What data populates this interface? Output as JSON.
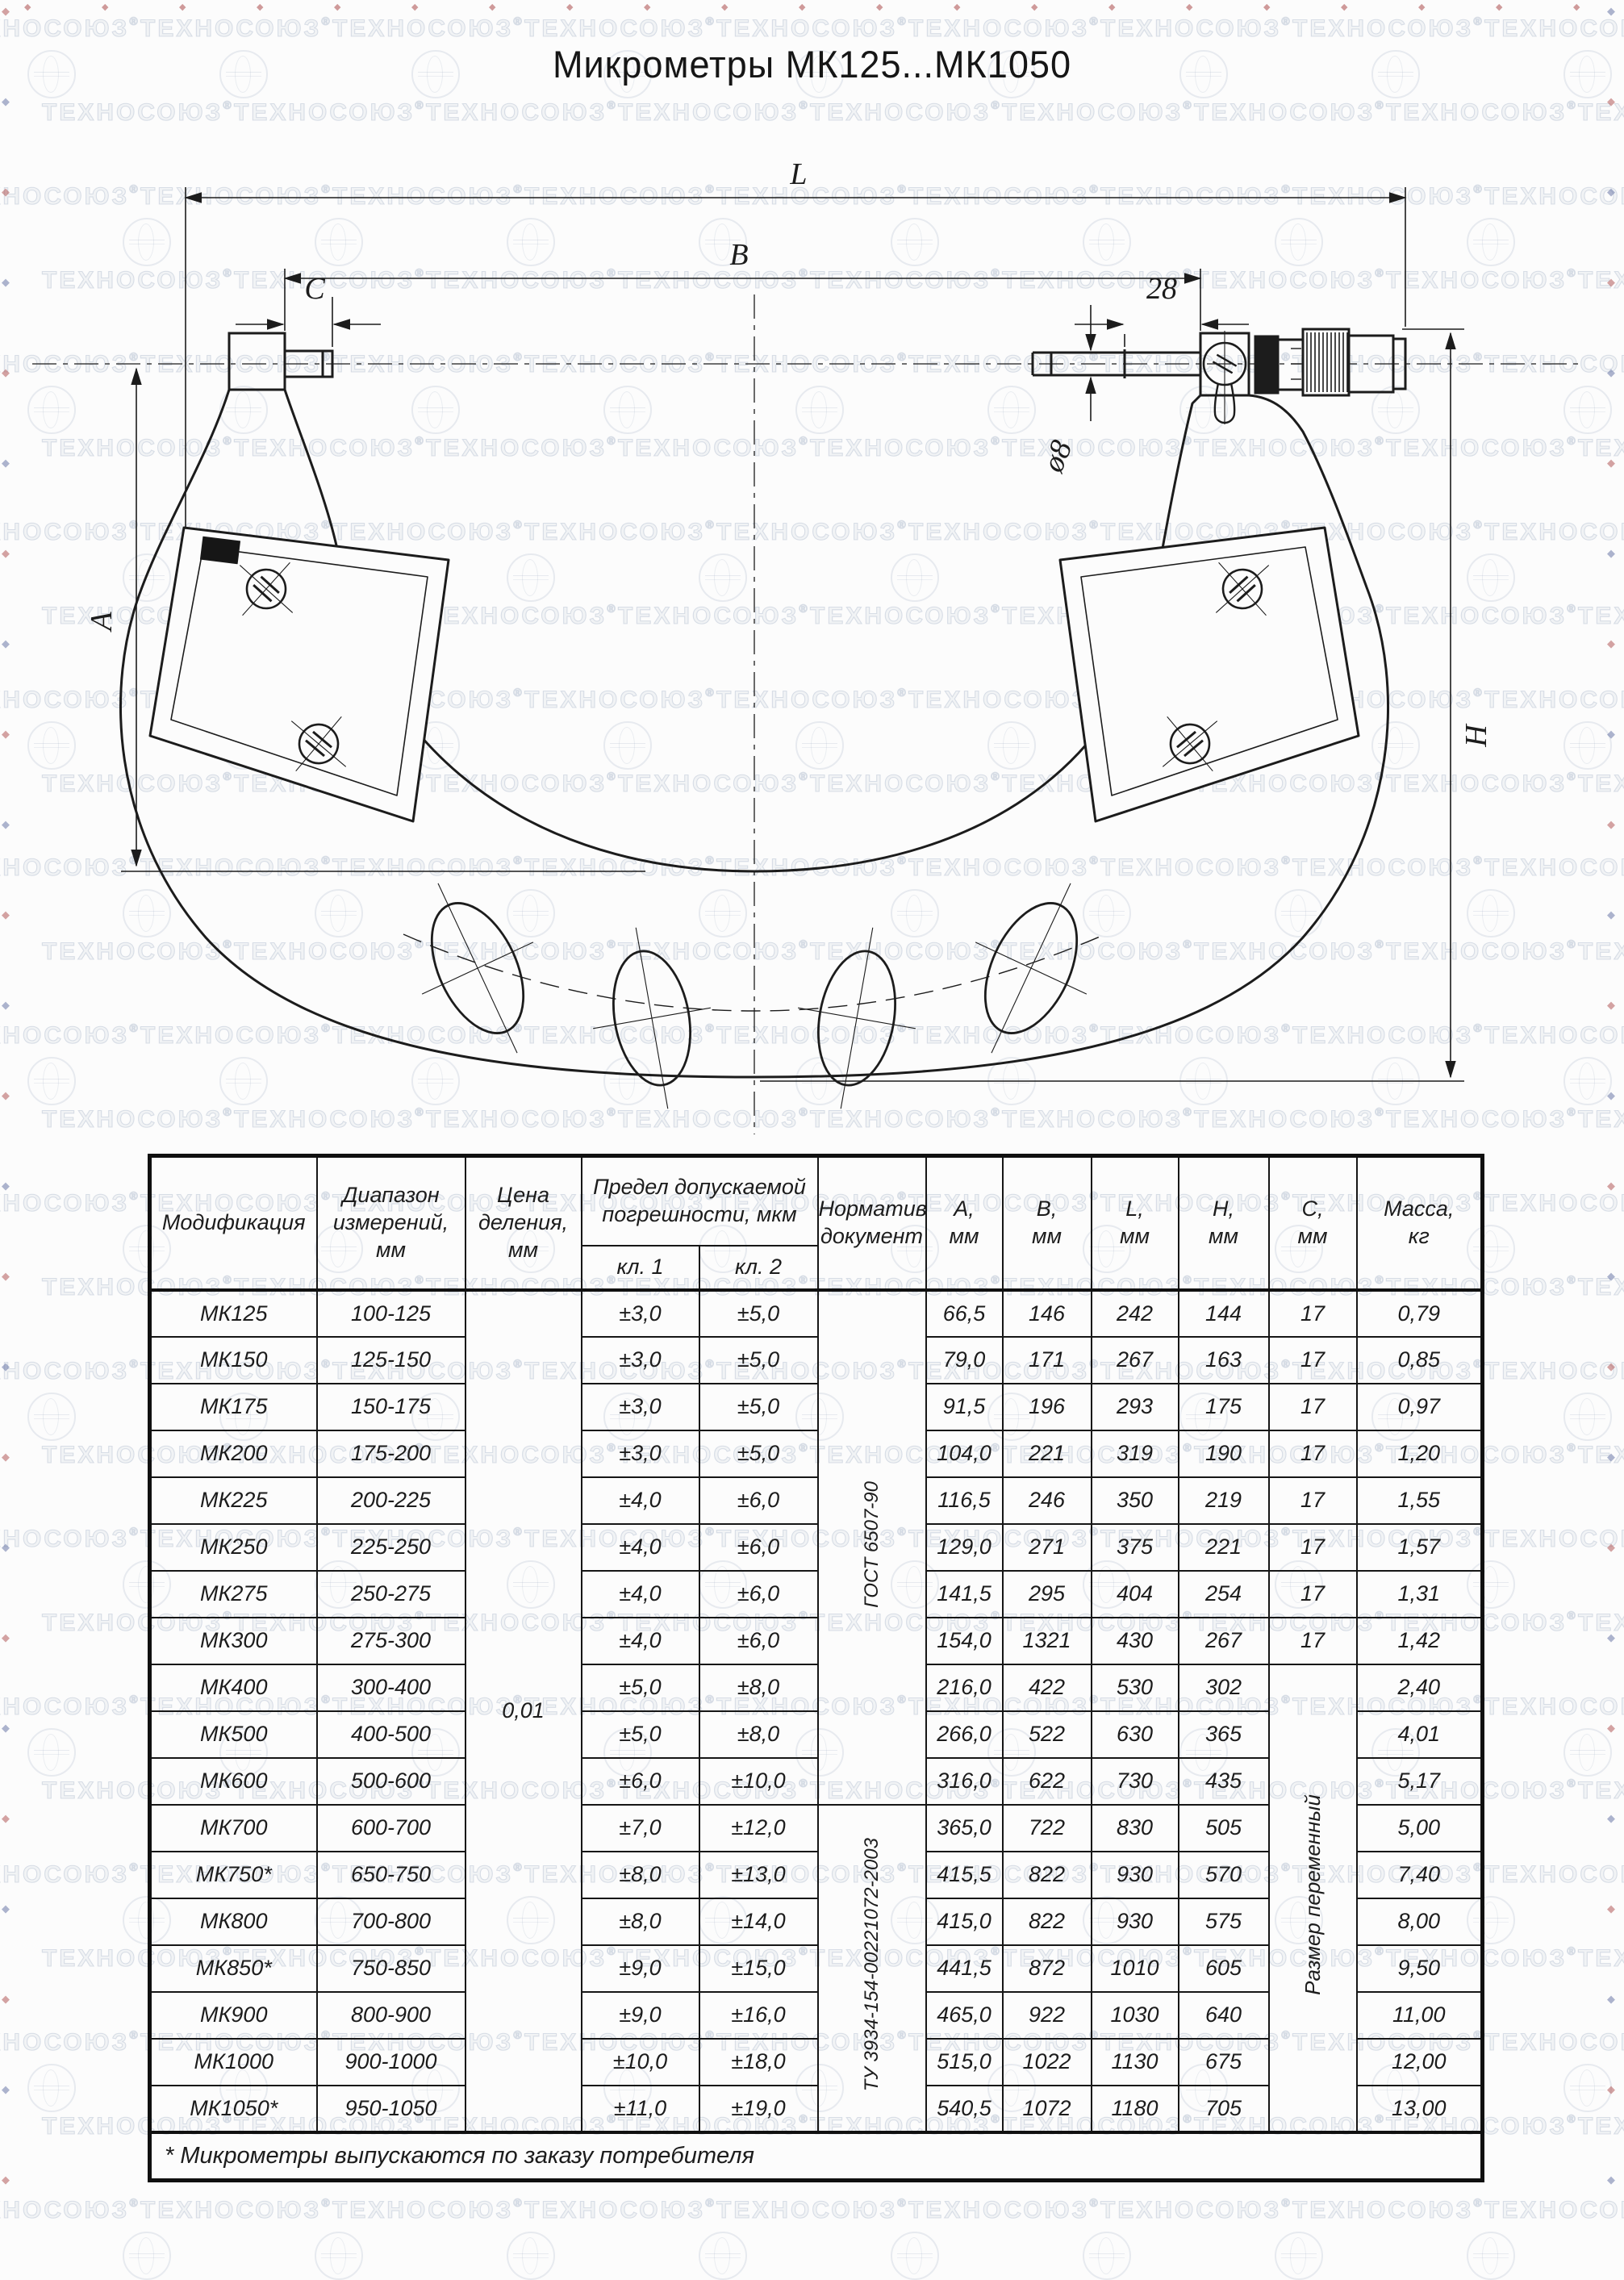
{
  "watermark": {
    "text": "ТЕХНОСОЮЗ",
    "reg": "®",
    "diamond": "◆",
    "edge_color_red": "#b25a5a",
    "edge_color_blue": "#6b79a8"
  },
  "title": "Микрометры МК125...МК1050",
  "drawing": {
    "dim_L": "L",
    "dim_B": "B",
    "dim_C": "C",
    "dim_28": "28",
    "dim_d8": "ø8",
    "dim_A": "A",
    "dim_H": "H"
  },
  "table": {
    "headers": {
      "model": "Модификация",
      "range": "Диапазон\nизмерений,\nмм",
      "division": "Цена\nделения,\nмм",
      "error": "Предел допускаемой\nпогрешности, мкм",
      "kl1": "кл. 1",
      "kl2": "кл. 2",
      "doc": "Нормативный\nдокумент",
      "col_a": "А,\nмм",
      "col_b": "В,\nмм",
      "col_l": "L,\nмм",
      "col_h": "Н,\nмм",
      "col_c": "С,\nмм",
      "mass": "Масса,\nкг"
    },
    "merged": {
      "division_value": "0,01",
      "doc_gost": "ГОСТ 6507-90",
      "doc_tu": "ТУ 3934-154-00221072-2003",
      "c_variable": "Размер переменный"
    },
    "rows": [
      {
        "model": "МК125",
        "range": "100-125",
        "kl1": "±3,0",
        "kl2": "±5,0",
        "a": "66,5",
        "b": "146",
        "l": "242",
        "h": "144",
        "c": "17",
        "mass": "0,79"
      },
      {
        "model": "МК150",
        "range": "125-150",
        "kl1": "±3,0",
        "kl2": "±5,0",
        "a": "79,0",
        "b": "171",
        "l": "267",
        "h": "163",
        "c": "17",
        "mass": "0,85"
      },
      {
        "model": "МК175",
        "range": "150-175",
        "kl1": "±3,0",
        "kl2": "±5,0",
        "a": "91,5",
        "b": "196",
        "l": "293",
        "h": "175",
        "c": "17",
        "mass": "0,97"
      },
      {
        "model": "МК200",
        "range": "175-200",
        "kl1": "±3,0",
        "kl2": "±5,0",
        "a": "104,0",
        "b": "221",
        "l": "319",
        "h": "190",
        "c": "17",
        "mass": "1,20"
      },
      {
        "model": "МК225",
        "range": "200-225",
        "kl1": "±4,0",
        "kl2": "±6,0",
        "a": "116,5",
        "b": "246",
        "l": "350",
        "h": "219",
        "c": "17",
        "mass": "1,55"
      },
      {
        "model": "МК250",
        "range": "225-250",
        "kl1": "±4,0",
        "kl2": "±6,0",
        "a": "129,0",
        "b": "271",
        "l": "375",
        "h": "221",
        "c": "17",
        "mass": "1,57"
      },
      {
        "model": "МК275",
        "range": "250-275",
        "kl1": "±4,0",
        "kl2": "±6,0",
        "a": "141,5",
        "b": "295",
        "l": "404",
        "h": "254",
        "c": "17",
        "mass": "1,31"
      },
      {
        "model": "МК300",
        "range": "275-300",
        "kl1": "±4,0",
        "kl2": "±6,0",
        "a": "154,0",
        "b": "1321",
        "l": "430",
        "h": "267",
        "c": "17",
        "mass": "1,42"
      },
      {
        "model": "МК400",
        "range": "300-400",
        "kl1": "±5,0",
        "kl2": "±8,0",
        "a": "216,0",
        "b": "422",
        "l": "530",
        "h": "302",
        "mass": "2,40"
      },
      {
        "model": "МК500",
        "range": "400-500",
        "kl1": "±5,0",
        "kl2": "±8,0",
        "a": "266,0",
        "b": "522",
        "l": "630",
        "h": "365",
        "mass": "4,01"
      },
      {
        "model": "МК600",
        "range": "500-600",
        "kl1": "±6,0",
        "kl2": "±10,0",
        "a": "316,0",
        "b": "622",
        "l": "730",
        "h": "435",
        "mass": "5,17"
      },
      {
        "model": "МК700",
        "range": "600-700",
        "kl1": "±7,0",
        "kl2": "±12,0",
        "a": "365,0",
        "b": "722",
        "l": "830",
        "h": "505",
        "mass": "5,00"
      },
      {
        "model": "МК750*",
        "range": "650-750",
        "kl1": "±8,0",
        "kl2": "±13,0",
        "a": "415,5",
        "b": "822",
        "l": "930",
        "h": "570",
        "mass": "7,40"
      },
      {
        "model": "МК800",
        "range": "700-800",
        "kl1": "±8,0",
        "kl2": "±14,0",
        "a": "415,0",
        "b": "822",
        "l": "930",
        "h": "575",
        "mass": "8,00"
      },
      {
        "model": "МК850*",
        "range": "750-850",
        "kl1": "±9,0",
        "kl2": "±15,0",
        "a": "441,5",
        "b": "872",
        "l": "1010",
        "h": "605",
        "mass": "9,50"
      },
      {
        "model": "МК900",
        "range": "800-900",
        "kl1": "±9,0",
        "kl2": "±16,0",
        "a": "465,0",
        "b": "922",
        "l": "1030",
        "h": "640",
        "mass": "11,00"
      },
      {
        "model": "МК1000",
        "range": "900-1000",
        "kl1": "±10,0",
        "kl2": "±18,0",
        "a": "515,0",
        "b": "1022",
        "l": "1130",
        "h": "675",
        "mass": "12,00"
      },
      {
        "model": "МК1050*",
        "range": "950-1050",
        "kl1": "±11,0",
        "kl2": "±19,0",
        "a": "540,5",
        "b": "1072",
        "l": "1180",
        "h": "705",
        "mass": "13,00"
      }
    ],
    "footnote": "* Микрометры выпускаются по заказу потребителя"
  }
}
